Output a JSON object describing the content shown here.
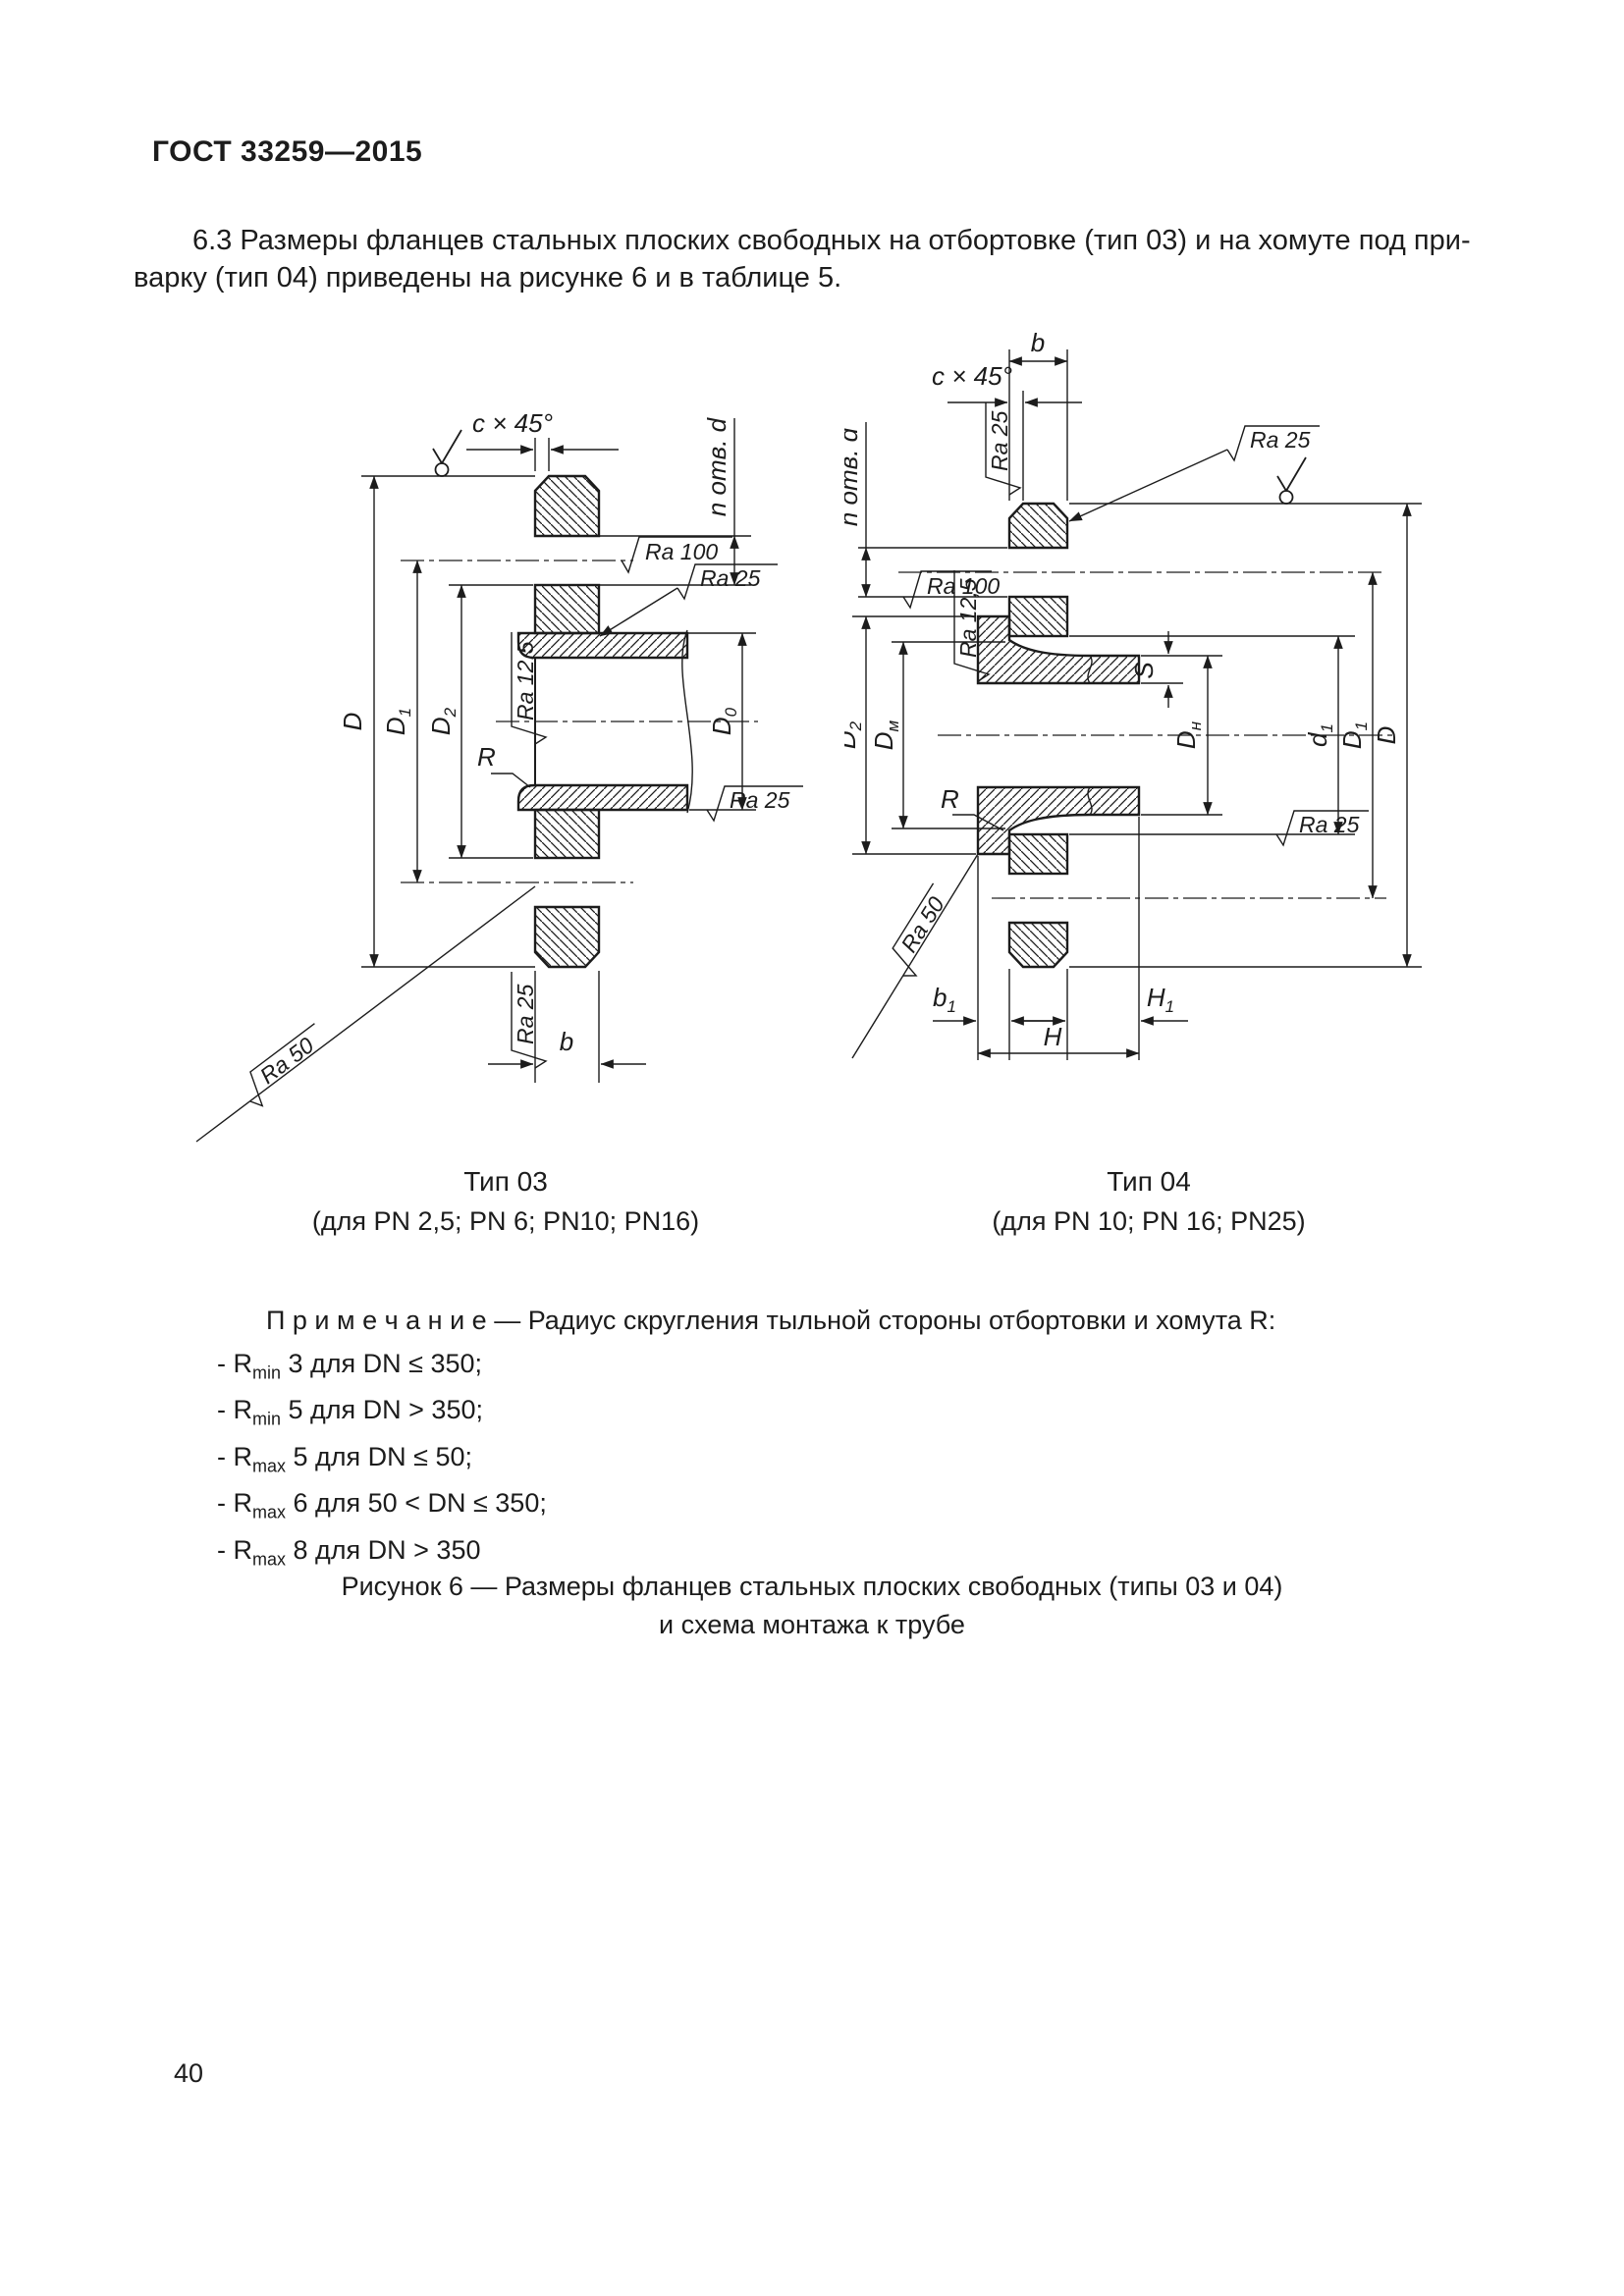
{
  "page": {
    "header": "ГОСТ 33259—2015",
    "para_line1": "6.3 Размеры фланцев стальных плоских свободных на отбортовке (тип 03) и на хомуте под при-",
    "para_line2": "варку (тип 04) приведены на рисунке 6 и в таблице 5.",
    "page_number": "40"
  },
  "figure": {
    "caption_line1": "Рисунок 6 — Размеры фланцев стальных плоских свободных (типы 03 и 04)",
    "caption_line2": "и схема монтажа к трубе",
    "type03": {
      "title": "Тип 03",
      "subtitle": "(для PN 2,5; PN 6; PN10; PN16)",
      "labels": {
        "D": "D",
        "D1_main": "D",
        "D1_sub": "1",
        "D2_main": "D",
        "D2_sub": "2",
        "D0_main": "D",
        "D0_sub": "0",
        "b": "b",
        "R": "R",
        "chamfer": "c × 45°",
        "holes": "n отв. d",
        "ra100": "Ra 100",
        "ra25": "Ra 25",
        "ra125": "Ra 12,5",
        "ra50": "Ra 50"
      }
    },
    "type04": {
      "title": "Тип 04",
      "subtitle": "(для PN 10; PN 16; PN25)",
      "labels": {
        "D": "D",
        "D1_main": "D",
        "D1_sub": "1",
        "D2_main": "D",
        "D2_sub": "2",
        "Dm_main": "D",
        "Dm_sub": "м",
        "Dn_main": "D",
        "Dn_sub": "н",
        "d1_main": "d",
        "d1_sub": "1",
        "b": "b",
        "b1_main": "b",
        "b1_sub": "1",
        "H": "H",
        "H1_main": "H",
        "H1_sub": "1",
        "S": "S",
        "R": "R",
        "chamfer": "c × 45°",
        "holes": "n отв. d",
        "ra100": "Ra 100",
        "ra25": "Ra 25",
        "ra125": "Ra 12,5",
        "ra50": "Ra 50"
      }
    }
  },
  "note": {
    "heading": "П р и м е ч а н и е — Радиус скругления тыльной стороны отбортовки и хомута R:",
    "items": [
      {
        "pre": "- R",
        "sub": "min",
        "rest": " 3 для DN ≤ 350;"
      },
      {
        "pre": "- R",
        "sub": "min",
        "rest": " 5 для DN > 350;"
      },
      {
        "pre": "- R",
        "sub": "max",
        "rest": " 5 для DN ≤ 50;"
      },
      {
        "pre": "- R",
        "sub": "max",
        "rest": " 6 для 50 < DN ≤ 350;"
      },
      {
        "pre": "- R",
        "sub": "max",
        "rest": " 8 для DN > 350"
      }
    ]
  }
}
